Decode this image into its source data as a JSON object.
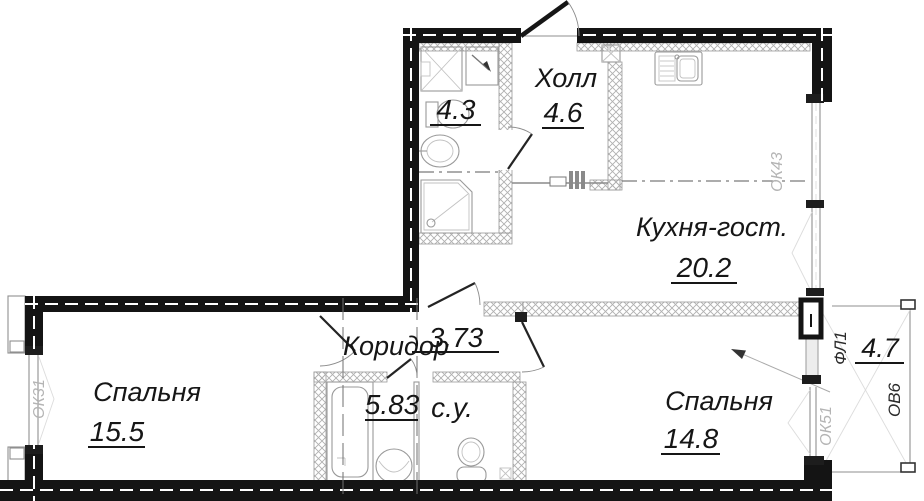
{
  "rooms": {
    "hall": {
      "name": "Холл",
      "area": "4.6"
    },
    "bathroom": {
      "area": "4.3"
    },
    "kitchen": {
      "name": "Кухня-гост.",
      "area": "20.2"
    },
    "corridor": {
      "name": "Коридор",
      "area": "3.73"
    },
    "bedroom_left": {
      "name": "Спальня",
      "area": "15.5"
    },
    "bathroom2": {
      "area": "5.83"
    },
    "wc": {
      "name": "с.у."
    },
    "bedroom_right": {
      "name": "Спальня",
      "area": "14.8"
    },
    "balcony": {
      "area": "4.7"
    }
  },
  "marks": {
    "left_window": "ОК31",
    "kitchen_window": "ОК43",
    "bedroom_window": "ОК51",
    "balcony_door": "ФЛ1",
    "balcony_window": "ОВ6"
  },
  "colors": {
    "wall": "#141414",
    "hatch_line": "#9a9a9a",
    "gray_mark": "#b4b4b4",
    "fixture_line": "#999999",
    "background": "#ffffff"
  }
}
